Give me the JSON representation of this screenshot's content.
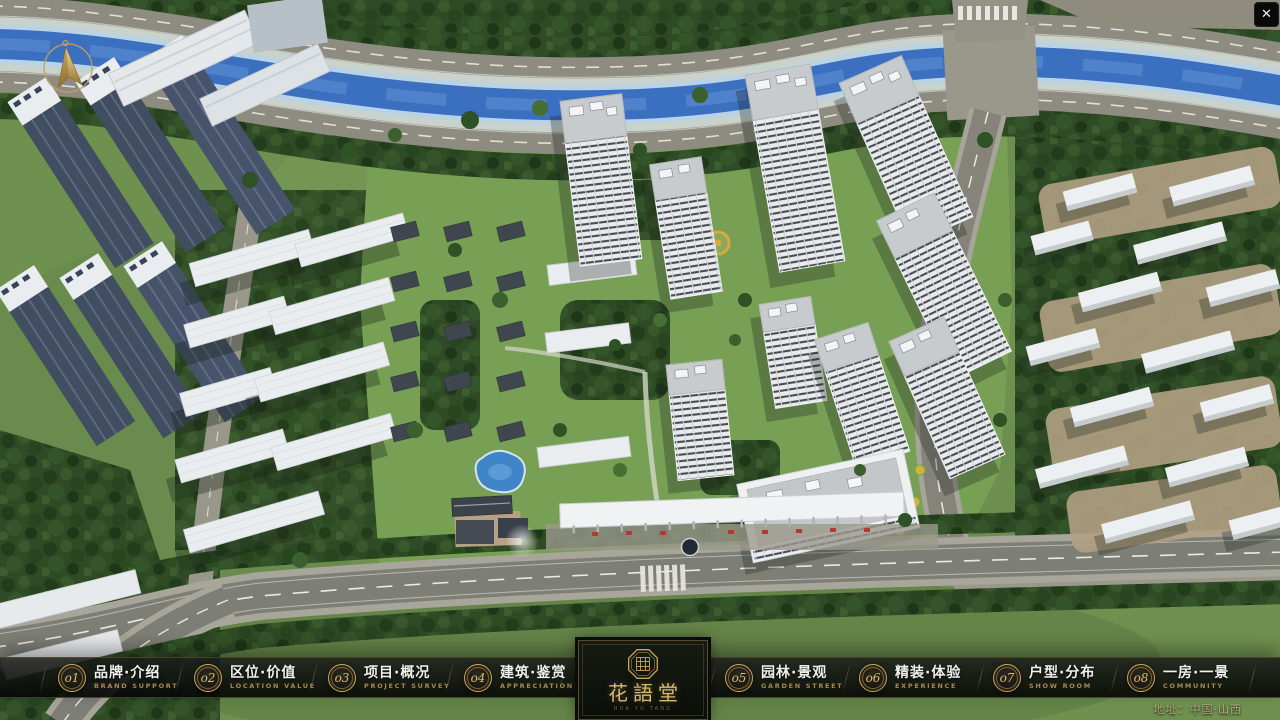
{
  "app": {
    "close_glyph": "✕"
  },
  "menu": {
    "items": [
      {
        "num": "o1",
        "zh": "品牌·介绍",
        "en": "BRAND SUPPORT"
      },
      {
        "num": "o2",
        "zh": "区位·价值",
        "en": "LOCATION VALUE"
      },
      {
        "num": "o3",
        "zh": "项目·概况",
        "en": "PROJECT SURVEY"
      },
      {
        "num": "o4",
        "zh": "建筑·鉴赏",
        "en": "APPRECIATION"
      },
      {
        "num": "o5",
        "zh": "园林·景观",
        "en": "GARDEN STREET"
      },
      {
        "num": "o6",
        "zh": "精装·体验",
        "en": "EXPERIENCE"
      },
      {
        "num": "o7",
        "zh": "户型·分布",
        "en": "SHOW ROOM"
      },
      {
        "num": "o8",
        "zh": "一房·一景",
        "en": "COMMUNITY"
      }
    ]
  },
  "logo": {
    "name": "花語堂",
    "subtitle": "HUA YU TANG"
  },
  "footer": {
    "address": "地址：中国·山西"
  },
  "colors": {
    "accent_gold": "#c9a55f",
    "nav_text": "#f0f1ec",
    "nav_sub": "#a8894c",
    "water": "#3b6fc0",
    "grass": "#6f9150"
  }
}
